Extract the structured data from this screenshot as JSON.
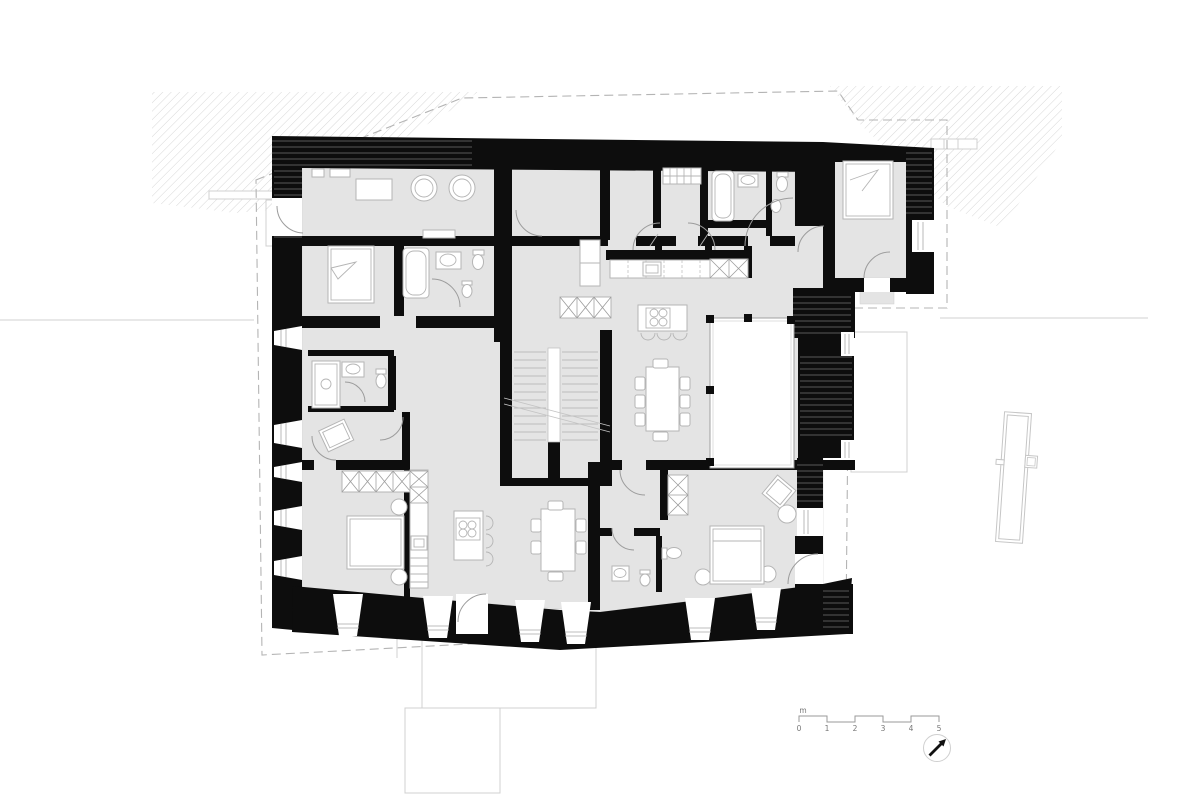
{
  "document": {
    "type": "architectural-floor-plan",
    "view": "floor plan with terrain hatching, roof overhang outline, scale bar and north arrow"
  },
  "colors": {
    "background": "#ffffff",
    "wall": "#0d0d0d",
    "floor": "#e4e4e4",
    "furniture_stroke": "#b5b5b5",
    "door_arc": "#9c9c9c",
    "dashed_outline": "#b4b4b4",
    "hatch": "#d7d7d7",
    "faint": "#d0d0d0",
    "text": "#777777",
    "north_arrow": "#111111"
  },
  "scale_bar": {
    "unit_label": "m",
    "tick_labels": [
      "0",
      "1",
      "2",
      "3",
      "4",
      "5"
    ]
  },
  "north_indicator": {
    "icon": "north-arrow-icon"
  },
  "symbols": [
    "terrain-hatch",
    "roof-overhang-dashed-outline",
    "site-reference-line",
    "wall-poche",
    "window-reveal",
    "door-swing",
    "stair-run",
    "bathtub-icon",
    "shower-icon",
    "washbasin-icon",
    "toilet-icon",
    "bidet-icon",
    "bed-icon",
    "wardrobe-x-icon",
    "kitchen-counter-icon",
    "cooktop-island-icon",
    "dining-table-icon",
    "glazed-court",
    "outbuilding-outline",
    "terrace-outline"
  ]
}
